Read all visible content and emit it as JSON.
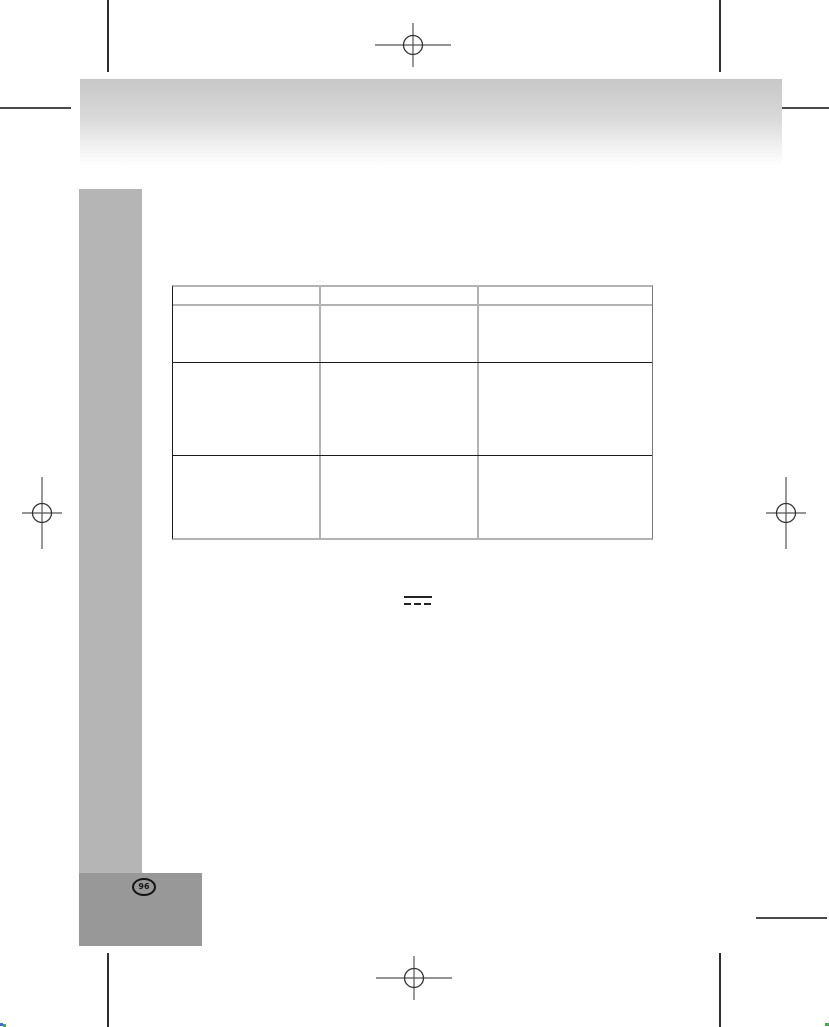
{
  "document": {
    "page_number_badge": "96"
  },
  "header_bar": {
    "gradient_top": "#c7c7c7",
    "gradient_bottom": "#ffffff"
  },
  "sidebar_bar": {
    "color": "#b5b5b5"
  },
  "footer_box": {
    "color": "#989898",
    "badge_shape": "circle-outline"
  },
  "table": {
    "columns": 3,
    "header_row": [
      "",
      "",
      ""
    ],
    "rows": [
      [
        "",
        "",
        ""
      ],
      [
        "",
        "",
        ""
      ],
      [
        "",
        "",
        ""
      ]
    ],
    "border_dark": "#1c1c1c",
    "border_light": "#b3b3b3"
  },
  "symbols": {
    "dc_power_icon": "direct-current (solid bar over dashed bar)"
  },
  "print_marks": {
    "registration_targets": [
      "top-center",
      "bottom-center",
      "left-middle",
      "right-middle"
    ],
    "crop_line_color": "#2e2e2e",
    "corner_dot_colors": [
      "#3f6fd0",
      "#3fae49"
    ]
  }
}
